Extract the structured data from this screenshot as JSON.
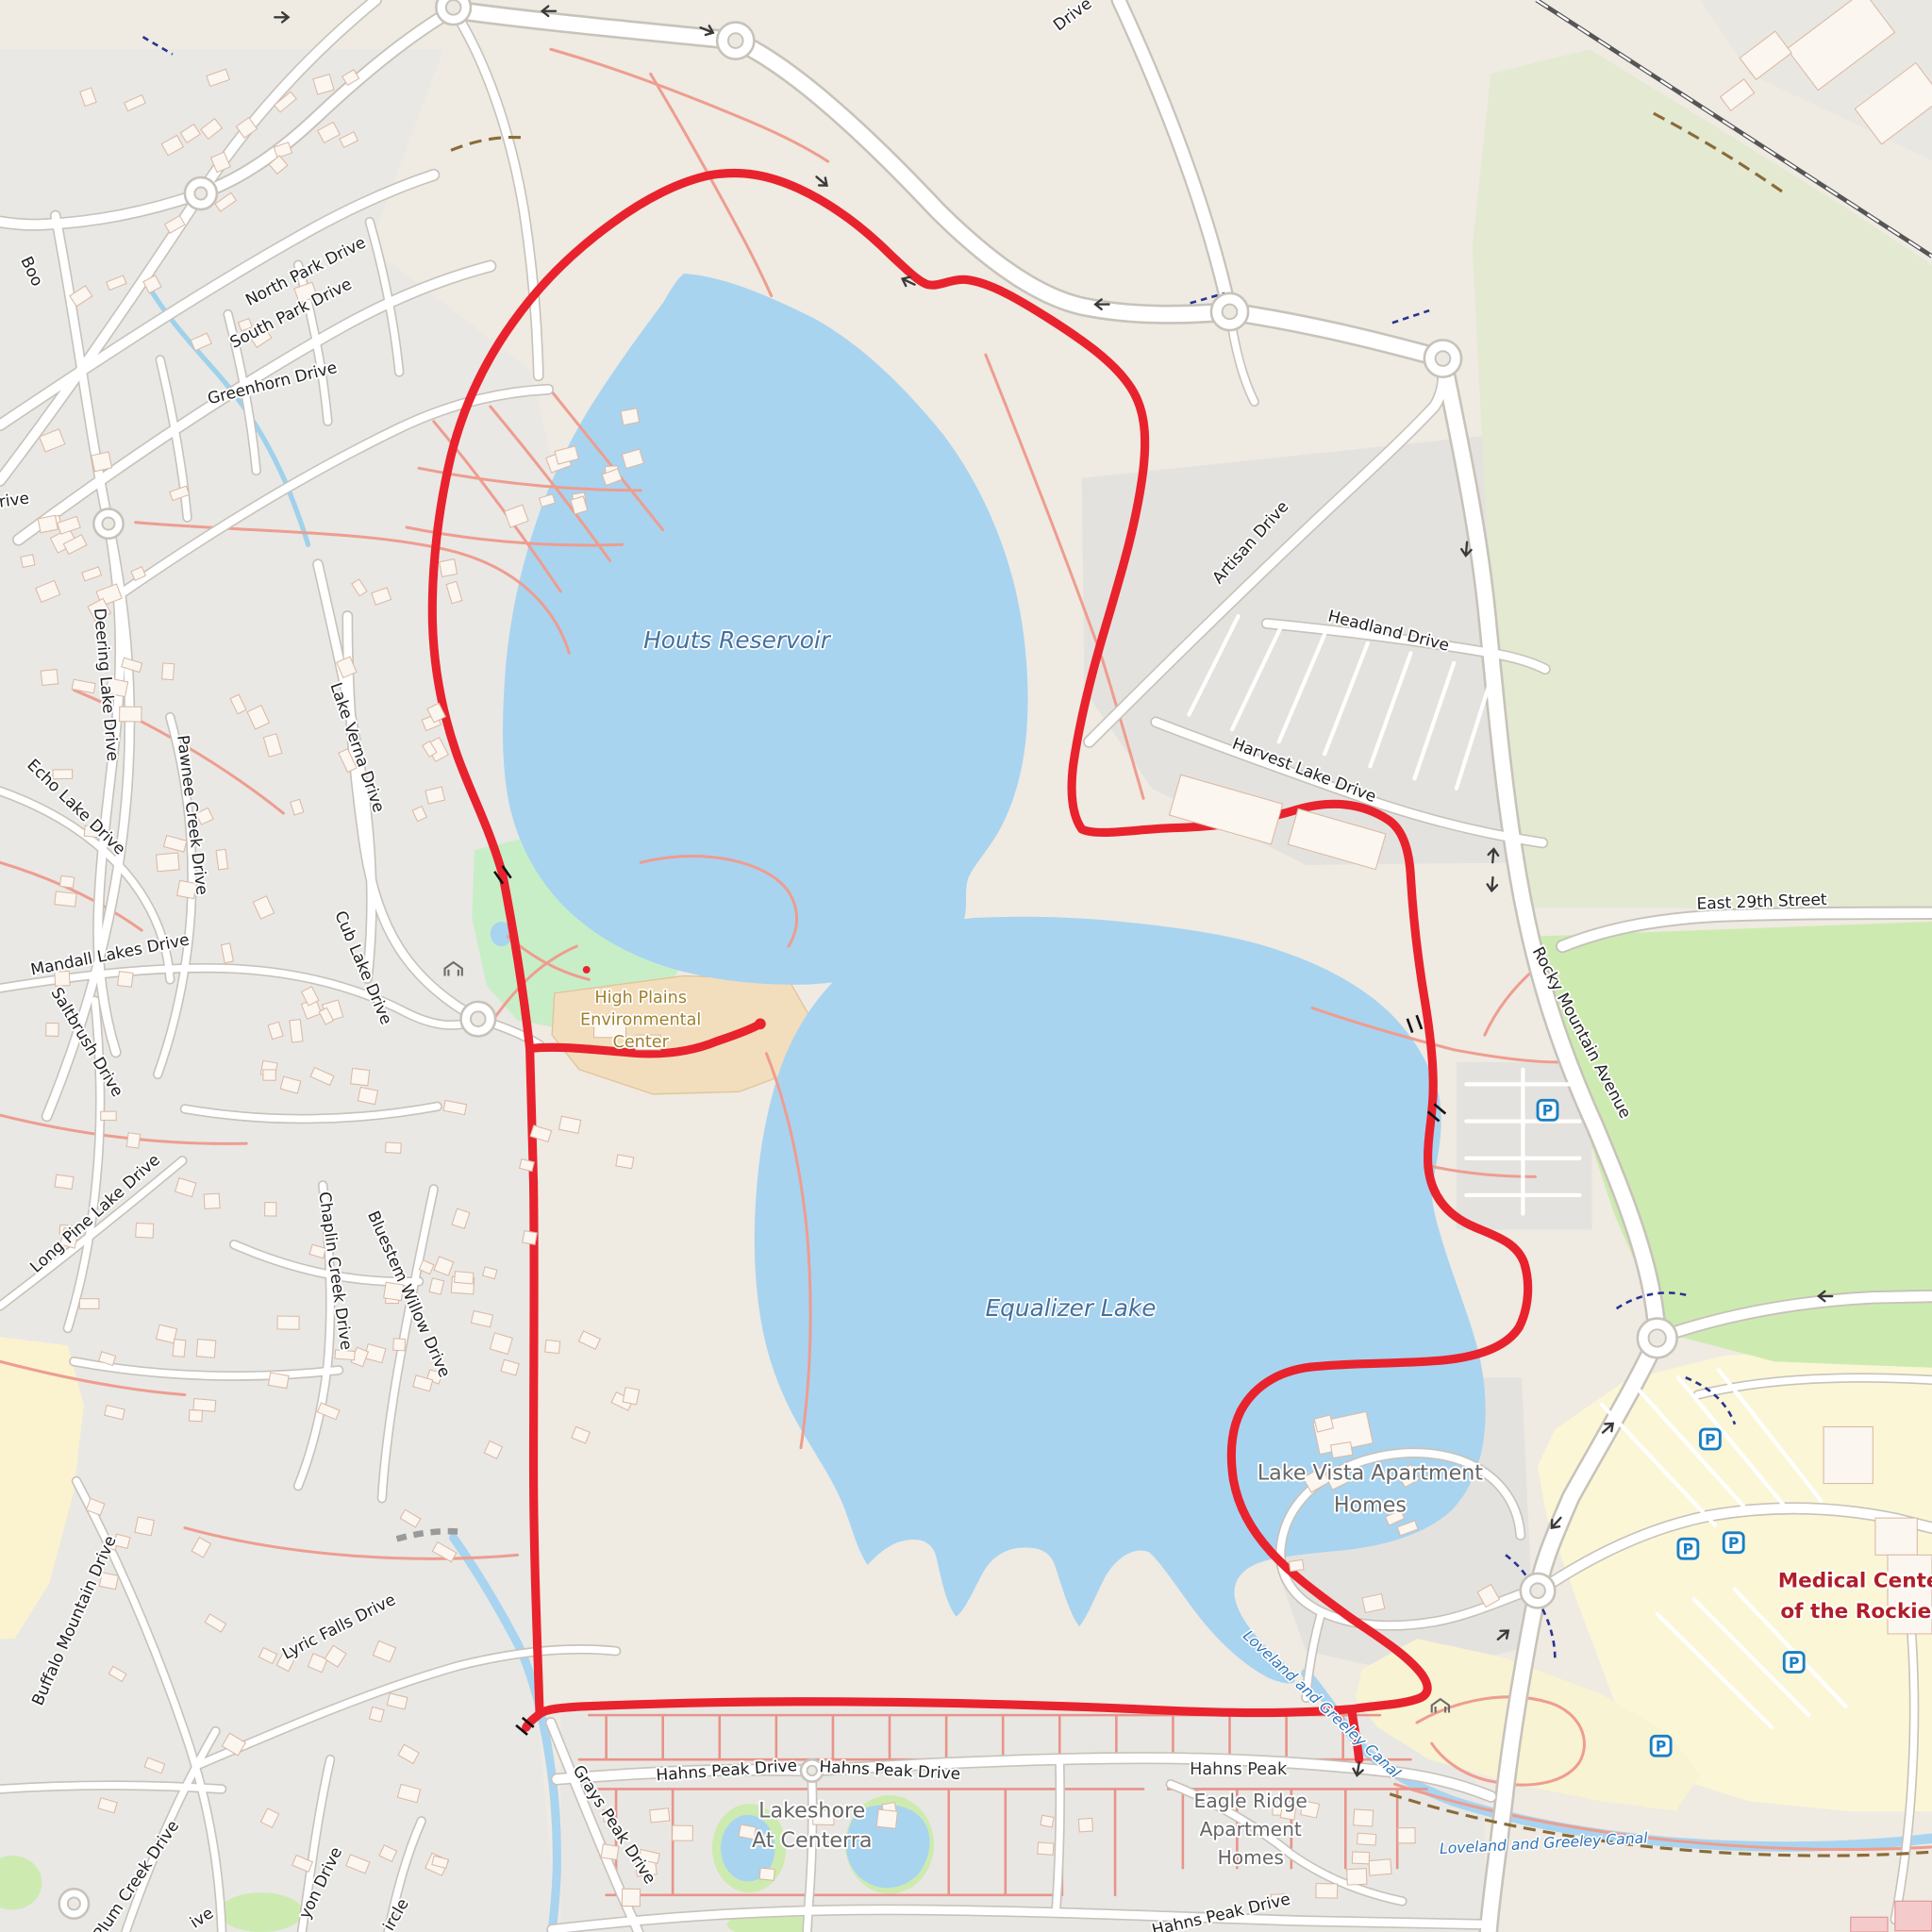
{
  "map": {
    "streets": {
      "north_park": "North Park Drive",
      "south_park": "South Park Drive",
      "greenhorn": "Greenhorn Drive",
      "deering": "Deering Lake Drive",
      "echo": "Echo Lake Drive",
      "pawnee": "Pawnee Creek Drive",
      "lake_verna": "Lake Verna Drive",
      "mandall": "Mandall Lakes Drive",
      "saltbrush": "Saltbrush Drive",
      "cub_lake": "Cub Lake Drive",
      "long_pine": "Long Pine Lake Drive",
      "chaplin": "Chaplin Creek Drive",
      "bluestem": "Bluestem Willow Drive",
      "buffalo": "Buffalo Mountain Drive",
      "lyric": "Lyric Falls Drive",
      "plum": "Plum Creek Drive",
      "artisan": "Artisan Drive",
      "headland": "Headland Drive",
      "harvest": "Harvest Lake Drive",
      "east_29th": "East 29th Street",
      "rocky_mountain": "Rocky Mountain Avenue",
      "hahns_peak_w": "Hahns Peak Drive",
      "hahns_peak_e": "Hahns Peak Drive",
      "hahns_peak_s": "Hahns Peak Drive",
      "grays_peak": "Grays Peak Drive"
    },
    "water": {
      "houts": "Houts Reservoir",
      "equalizer": "Equalizer Lake",
      "canal": "Loveland and Greeley Canal"
    },
    "places": {
      "high_plains": [
        "High Plains",
        "Environmental",
        "Center"
      ],
      "lake_vista": [
        "Lake Vista Apartment",
        "Homes"
      ],
      "medical_center": [
        "Medical Center",
        "of the Rockies"
      ],
      "lakeshore": [
        "Lakeshore",
        "At Centerra"
      ],
      "eagle_ridge": [
        "Eagle Ridge",
        "Apartment",
        "Homes"
      ],
      "hahns_peak": "Hahns Peak"
    },
    "partials": {
      "top_drive": "Drive",
      "boo": "Boo",
      "rive": "rive",
      "canyon": "yon Drive",
      "circle": "ircle",
      "ive": "ive"
    },
    "icons": {
      "parking": "P"
    },
    "colors": {
      "route": "#e8232d",
      "water": "#a8d4f0",
      "grass": "#cdebb0",
      "medical_text": "#b01e28",
      "water_text": "#44719e",
      "env_center_text": "#a0802e"
    }
  }
}
